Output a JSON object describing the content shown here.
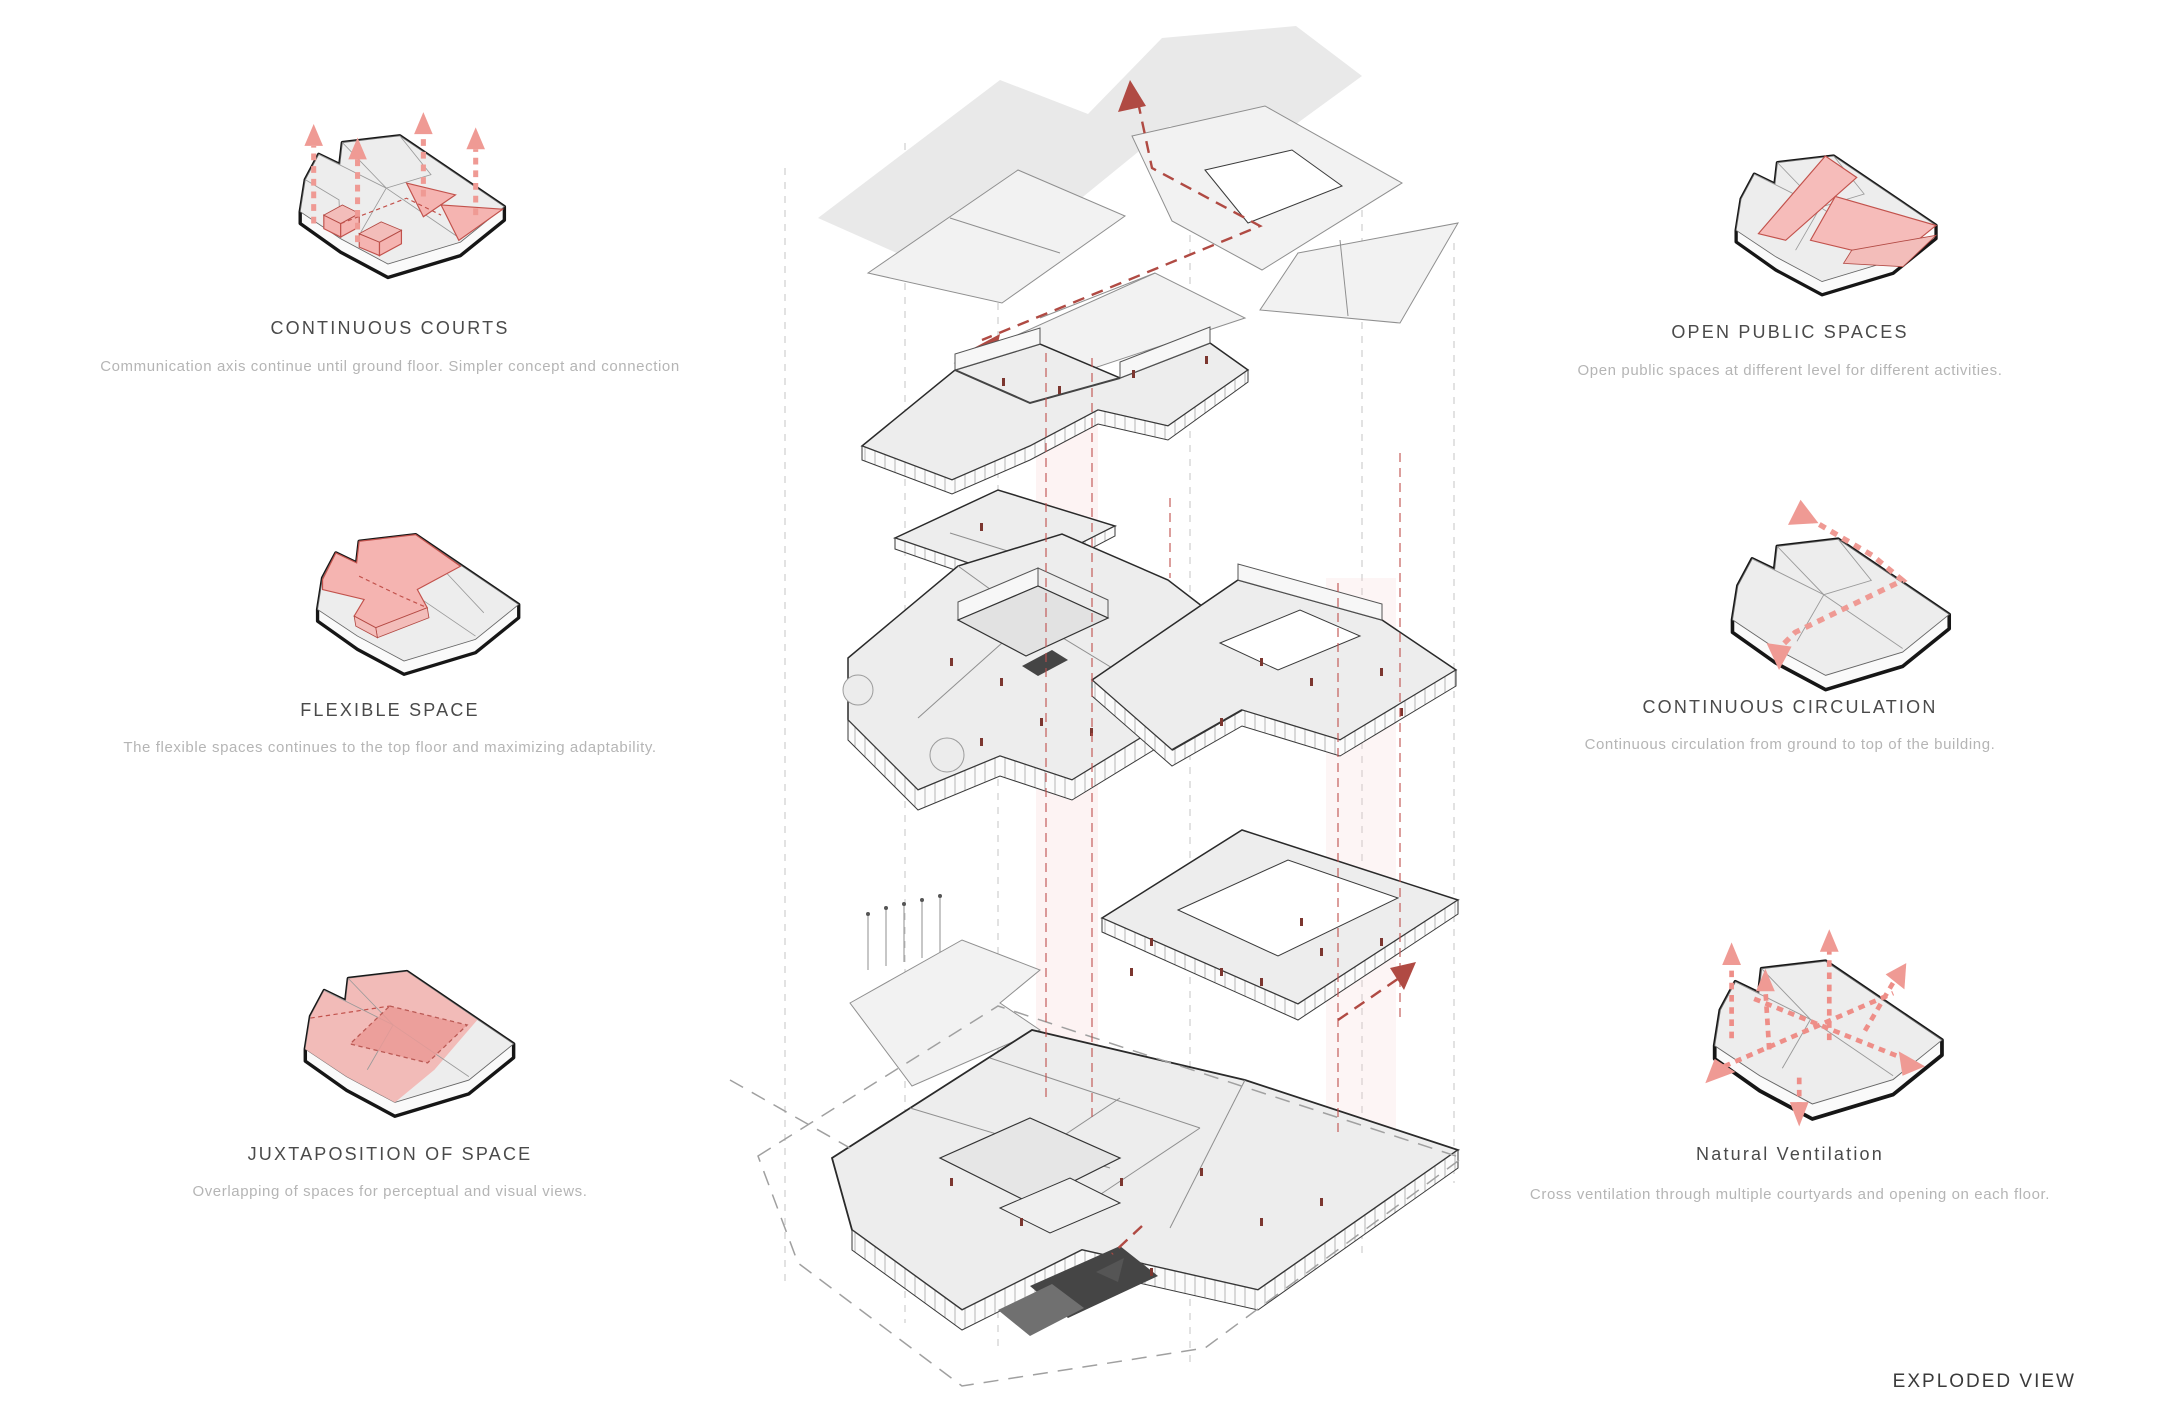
{
  "page_title": "Exploded axonometric architecture concept board",
  "panels": [
    {
      "id": "continuous-courts",
      "title": "CONTINUOUS COURTS",
      "description": "Communication axis continue until ground floor. Simpler concept and connection",
      "icon": "continuous-courts-axon-icon"
    },
    {
      "id": "flexible-space",
      "title": "FLEXIBLE SPACE",
      "description": "The flexible spaces continues to the top floor and maximizing adaptability.",
      "icon": "flexible-space-axon-icon"
    },
    {
      "id": "juxtaposition-of-space",
      "title": "JUXTAPOSITION OF SPACE",
      "description": "Overlapping of spaces for perceptual and visual views.",
      "icon": "juxtaposition-of-space-axon-icon"
    },
    {
      "id": "open-public-spaces",
      "title": "OPEN PUBLIC SPACES",
      "description": "Open public spaces at different level for different activities.",
      "icon": "open-public-spaces-axon-icon"
    },
    {
      "id": "continuous-circulation",
      "title": "CONTINUOUS CIRCULATION",
      "description": "Continuous circulation from ground to top of the building.",
      "icon": "continuous-circulation-axon-icon"
    },
    {
      "id": "natural-ventilation",
      "title": "Natural Ventilation",
      "description": "Cross ventilation through multiple courtyards and opening on each floor.",
      "icon": "natural-ventilation-axon-icon"
    }
  ],
  "footer": {
    "label": "EXPLODED VIEW"
  },
  "colors": {
    "highlight_pink": "#f5b4b1",
    "highlight_stroke": "#c2524c",
    "arrow_red": "#b04a43",
    "plate_fill": "#ededed",
    "outline": "#1c1c1c",
    "title_text": "#4a4a4a",
    "desc_text": "#b5b5b5"
  }
}
